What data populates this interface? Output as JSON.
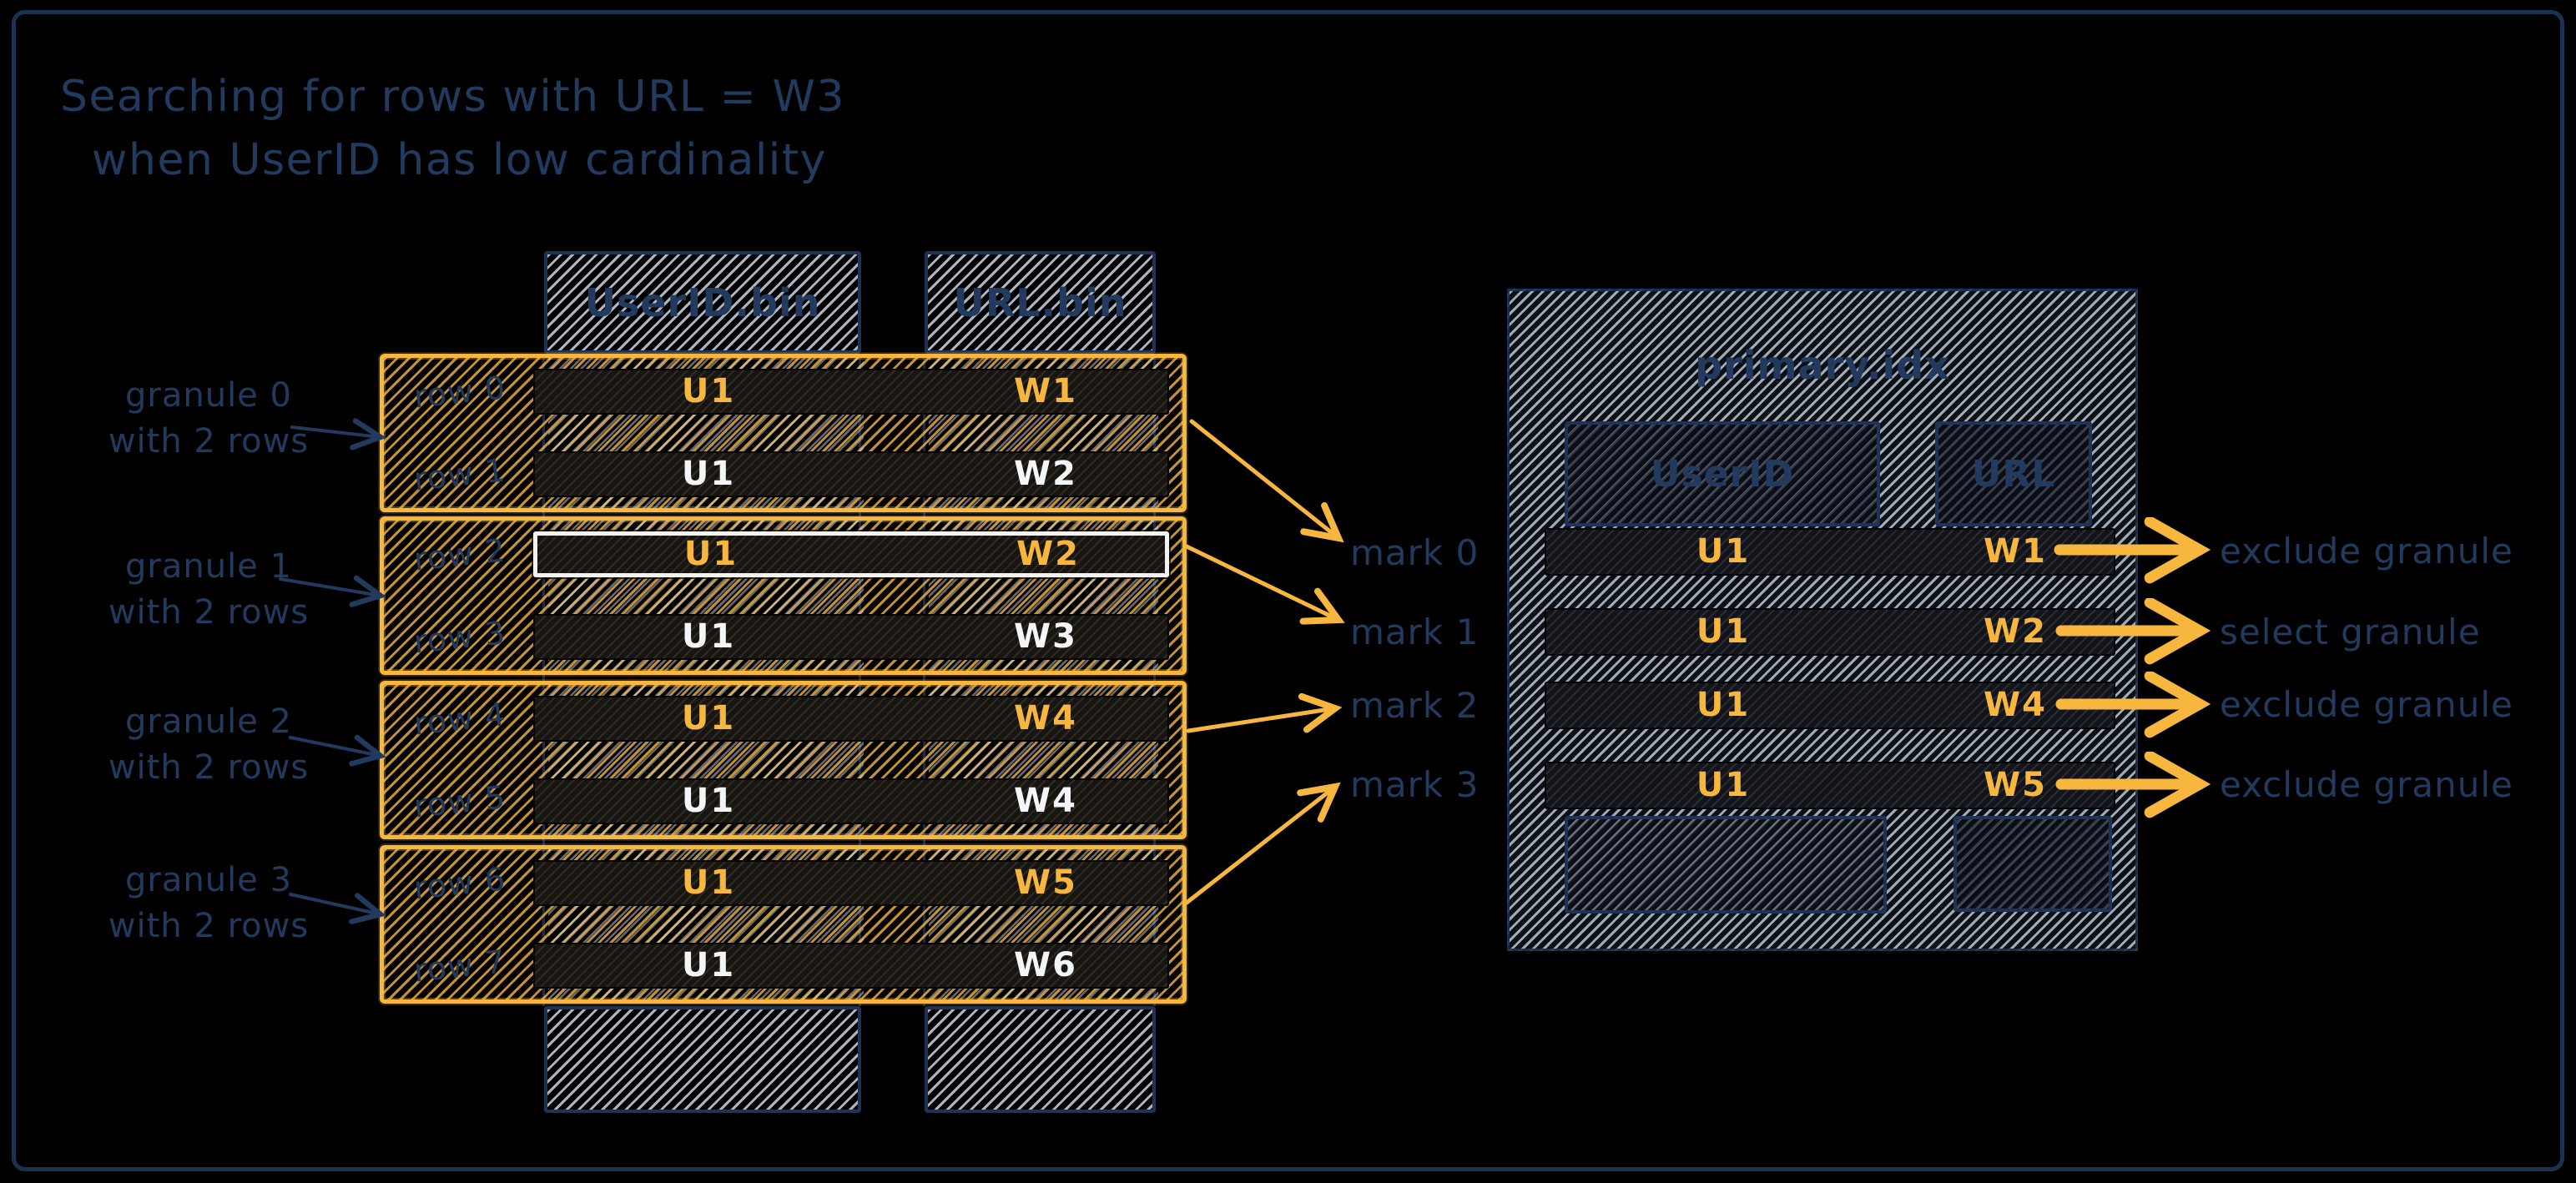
{
  "title": {
    "line1": "Searching for rows with URL = W3",
    "line2": "when UserID has low cardinality"
  },
  "left_table": {
    "columns": [
      {
        "label": "UserID.bin"
      },
      {
        "label": "URL.bin"
      }
    ],
    "granules": [
      {
        "label_line1": "granule 0",
        "label_line2": "with 2 rows",
        "rows": [
          {
            "row_label": "row 0",
            "user_id": "U1",
            "url": "W1",
            "accent": "orange",
            "highlighted": false
          },
          {
            "row_label": "row 1",
            "user_id": "U1",
            "url": "W2",
            "accent": "white",
            "highlighted": false
          }
        ]
      },
      {
        "label_line1": "granule 1",
        "label_line2": "with 2 rows",
        "rows": [
          {
            "row_label": "row 2",
            "user_id": "U1",
            "url": "W2",
            "accent": "orange",
            "highlighted": true
          },
          {
            "row_label": "row 3",
            "user_id": "U1",
            "url": "W3",
            "accent": "white",
            "highlighted": false
          }
        ]
      },
      {
        "label_line1": "granule 2",
        "label_line2": "with 2 rows",
        "rows": [
          {
            "row_label": "row 4",
            "user_id": "U1",
            "url": "W4",
            "accent": "orange",
            "highlighted": false
          },
          {
            "row_label": "row 5",
            "user_id": "U1",
            "url": "W4",
            "accent": "white",
            "highlighted": false
          }
        ]
      },
      {
        "label_line1": "granule 3",
        "label_line2": "with 2 rows",
        "rows": [
          {
            "row_label": "row 6",
            "user_id": "U1",
            "url": "W5",
            "accent": "orange",
            "highlighted": false
          },
          {
            "row_label": "row 7",
            "user_id": "U1",
            "url": "W6",
            "accent": "white",
            "highlighted": false
          }
        ]
      }
    ]
  },
  "marks": [
    {
      "label": "mark 0"
    },
    {
      "label": "mark 1"
    },
    {
      "label": "mark 2"
    },
    {
      "label": "mark 3"
    }
  ],
  "primary_index": {
    "title": "primary.idx",
    "columns": [
      {
        "label": "UserID"
      },
      {
        "label": "URL"
      }
    ],
    "rows": [
      {
        "user_id": "U1",
        "url": "W1"
      },
      {
        "user_id": "U1",
        "url": "W2"
      },
      {
        "user_id": "U1",
        "url": "W4"
      },
      {
        "user_id": "U1",
        "url": "W5"
      }
    ]
  },
  "actions": [
    {
      "label": "exclude granule"
    },
    {
      "label": "select granule"
    },
    {
      "label": "exclude granule"
    },
    {
      "label": "exclude granule"
    }
  ],
  "colors": {
    "background": "#000000",
    "frame": "#1d3154",
    "navy": "#223a5e",
    "orange": "#f7b63d",
    "white": "#f4f5f7",
    "hatch_light": "#cdd5e1",
    "row_dark": "#18140f"
  }
}
